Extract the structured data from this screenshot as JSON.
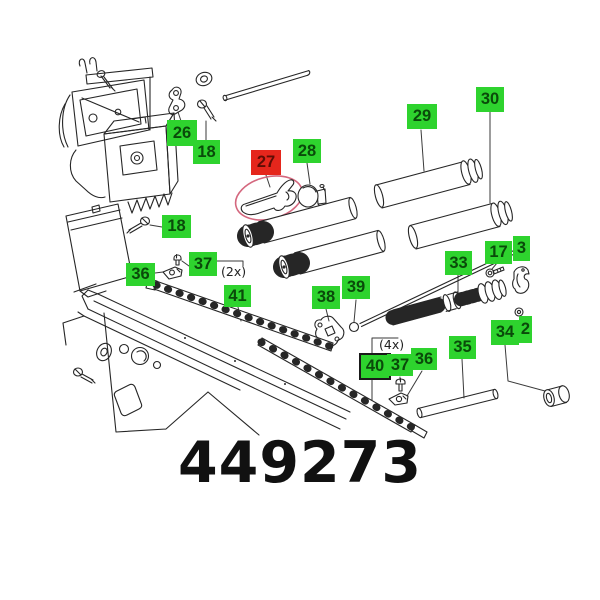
{
  "diagram": {
    "part_number": "449273",
    "labels": [
      {
        "number": "26",
        "x": 167,
        "y": 120,
        "w": 30,
        "h": 26,
        "highlighted": false
      },
      {
        "number": "18",
        "x": 193,
        "y": 140,
        "w": 27,
        "h": 24,
        "highlighted": false
      },
      {
        "number": "27",
        "x": 251,
        "y": 150,
        "w": 30,
        "h": 25,
        "highlighted": true
      },
      {
        "number": "28",
        "x": 293,
        "y": 139,
        "w": 28,
        "h": 24,
        "highlighted": false
      },
      {
        "number": "29",
        "x": 407,
        "y": 104,
        "w": 30,
        "h": 25,
        "highlighted": false
      },
      {
        "number": "30",
        "x": 476,
        "y": 87,
        "w": 28,
        "h": 25,
        "highlighted": false
      },
      {
        "number": "18",
        "x": 162,
        "y": 215,
        "w": 29,
        "h": 23,
        "highlighted": false
      },
      {
        "number": "36",
        "x": 126,
        "y": 263,
        "w": 29,
        "h": 23,
        "highlighted": false
      },
      {
        "number": "37",
        "x": 189,
        "y": 252,
        "w": 28,
        "h": 24,
        "highlighted": false
      },
      {
        "number": "41",
        "x": 224,
        "y": 285,
        "w": 27,
        "h": 22,
        "highlighted": false
      },
      {
        "number": "38",
        "x": 312,
        "y": 286,
        "w": 28,
        "h": 23,
        "highlighted": false
      },
      {
        "number": "39",
        "x": 342,
        "y": 276,
        "w": 28,
        "h": 23,
        "highlighted": false
      },
      {
        "number": "33",
        "x": 445,
        "y": 251,
        "w": 27,
        "h": 24,
        "highlighted": false
      },
      {
        "number": "17",
        "x": 485,
        "y": 241,
        "w": 27,
        "h": 23,
        "highlighted": false
      },
      {
        "number": "3",
        "x": 513,
        "y": 236,
        "w": 17,
        "h": 25,
        "highlighted": false,
        "clipped": true
      },
      {
        "number": "40",
        "x": 359,
        "y": 353,
        "w": 28,
        "h": 23,
        "highlighted": false,
        "bordered": true
      },
      {
        "number": "37",
        "x": 387,
        "y": 354,
        "w": 26,
        "h": 22,
        "highlighted": false
      },
      {
        "number": "36",
        "x": 411,
        "y": 348,
        "w": 26,
        "h": 22,
        "highlighted": false
      },
      {
        "number": "35",
        "x": 449,
        "y": 336,
        "w": 27,
        "h": 23,
        "highlighted": false
      },
      {
        "number": "34",
        "x": 491,
        "y": 320,
        "w": 28,
        "h": 25,
        "highlighted": false
      },
      {
        "number": "2",
        "x": 519,
        "y": 316,
        "w": 13,
        "h": 27,
        "highlighted": false,
        "clipped": true
      }
    ],
    "quantity_notes": [
      {
        "text": "(2x)",
        "x": 221,
        "y": 264
      },
      {
        "text": "(4x)",
        "x": 379,
        "y": 337
      }
    ],
    "colors": {
      "label_bg": "#2ed32e",
      "label_text": "#0a4a0a",
      "highlight_bg": "#e5261c",
      "highlight_text": "#5f0d05",
      "line": "#262626",
      "highlight_ellipse": "#d4677e"
    }
  }
}
